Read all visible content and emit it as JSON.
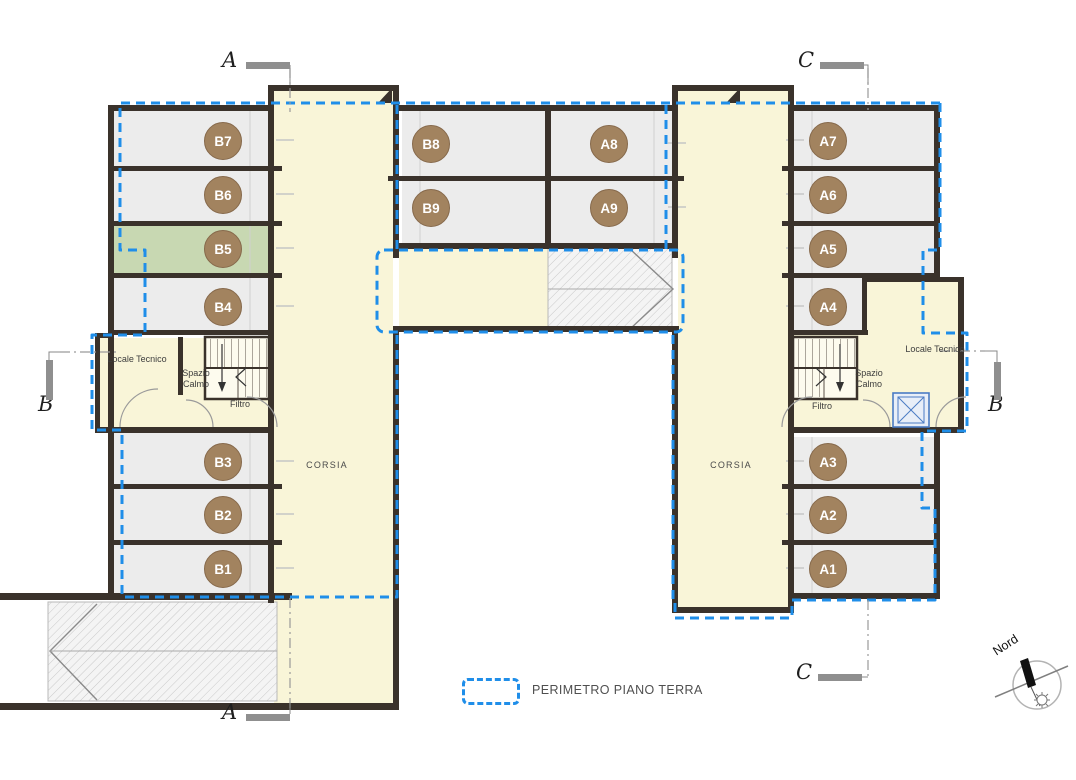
{
  "rooms": {
    "b1": "B1",
    "b2": "B2",
    "b3": "B3",
    "b4": "B4",
    "b5": "B5",
    "b6": "B6",
    "b7": "B7",
    "b8": "B8",
    "b9": "B9",
    "a1": "A1",
    "a2": "A2",
    "a3": "A3",
    "a4": "A4",
    "a5": "A5",
    "a6": "A6",
    "a7": "A7",
    "a8": "A8",
    "a9": "A9"
  },
  "corridors": {
    "left": "CORSIA",
    "right": "CORSIA"
  },
  "service_rooms": {
    "locale_tecnico_left": "Locale Tecnico",
    "spazio_calmo_left": "Spazio Calmo",
    "filtro_left": "Filtro",
    "locale_tecnico_right": "Locale Tecnico",
    "spazio_calmo_right": "Spazio Calmo",
    "filtro_right": "Filtro"
  },
  "section_markers": {
    "a_top": "A",
    "a_bottom": "A",
    "b_left": "B",
    "b_right": "B",
    "c_top": "C",
    "c_bottom": "C"
  },
  "legend": {
    "label": "PERIMETRO PIANO TERRA"
  },
  "compass": {
    "label": "Nord"
  },
  "colors": {
    "perimeter_blue": "#1f8ee9",
    "wall_dark": "#3a322b",
    "room_gray": "#ececec",
    "room_green": "#c8d8b2",
    "corridor_yellow": "#f9f5d8",
    "label_chip_brown": "#a2835f"
  }
}
